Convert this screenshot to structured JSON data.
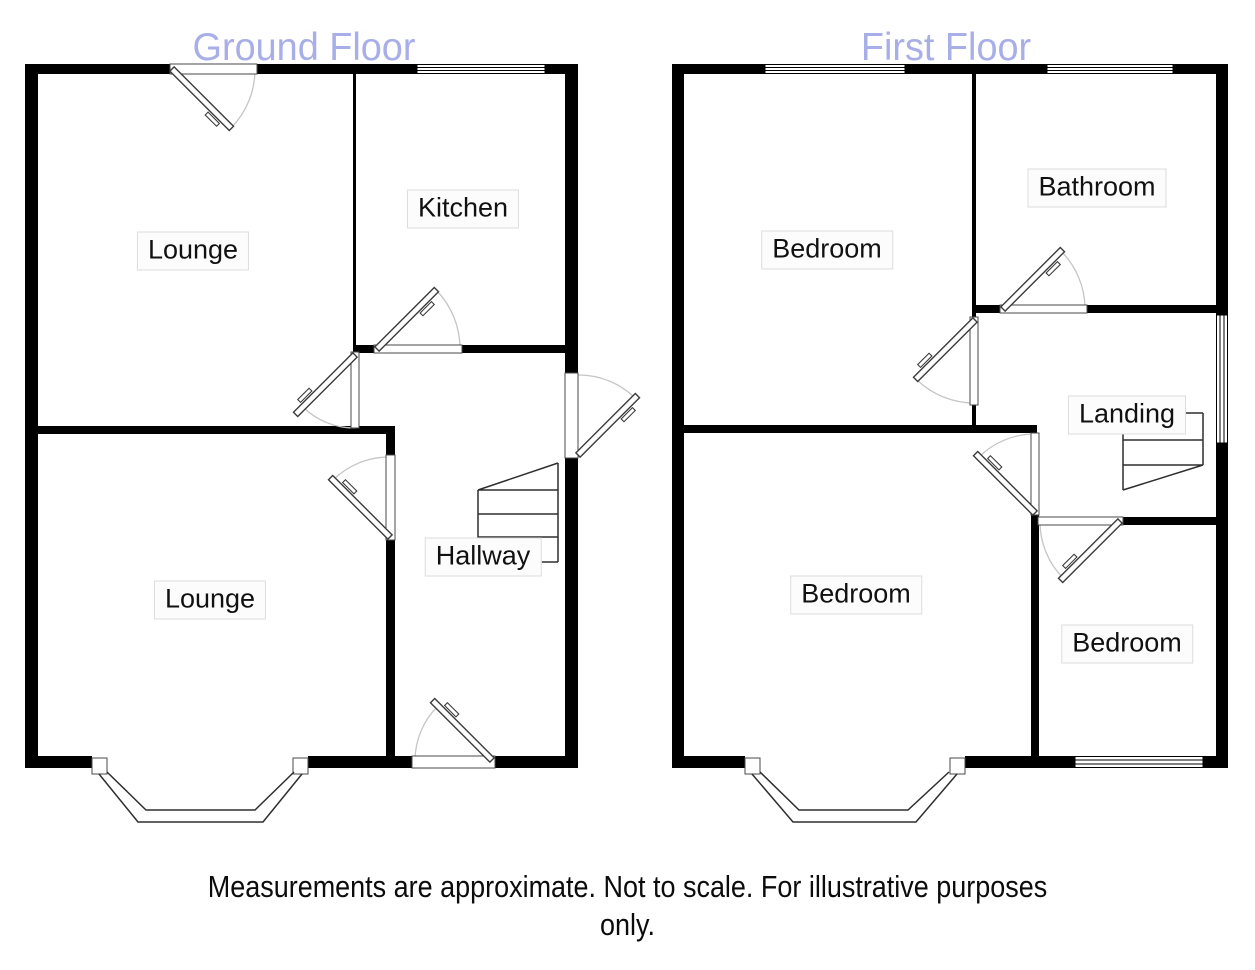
{
  "floors": {
    "ground": {
      "title": "Ground Floor",
      "rooms": [
        {
          "label": "Lounge"
        },
        {
          "label": "Kitchen"
        },
        {
          "label": "Lounge"
        },
        {
          "label": "Hallway"
        }
      ]
    },
    "first": {
      "title": "First Floor",
      "rooms": [
        {
          "label": "Bedroom"
        },
        {
          "label": "Bathroom"
        },
        {
          "label": "Landing"
        },
        {
          "label": "Bedroom"
        },
        {
          "label": "Bedroom"
        }
      ]
    }
  },
  "disclaimer": {
    "line1": "Measurements are approximate. Not to scale. For illustrative purposes",
    "line2": "only."
  },
  "colors": {
    "title_text": "#a8aee8",
    "wall": "#000000",
    "door_leaf": "#3c3c3c",
    "door_arc": "#c5c5c5",
    "label_border": "#dddddd",
    "label_background": "#fcfcfc",
    "text": "#111111",
    "background": "#ffffff"
  }
}
